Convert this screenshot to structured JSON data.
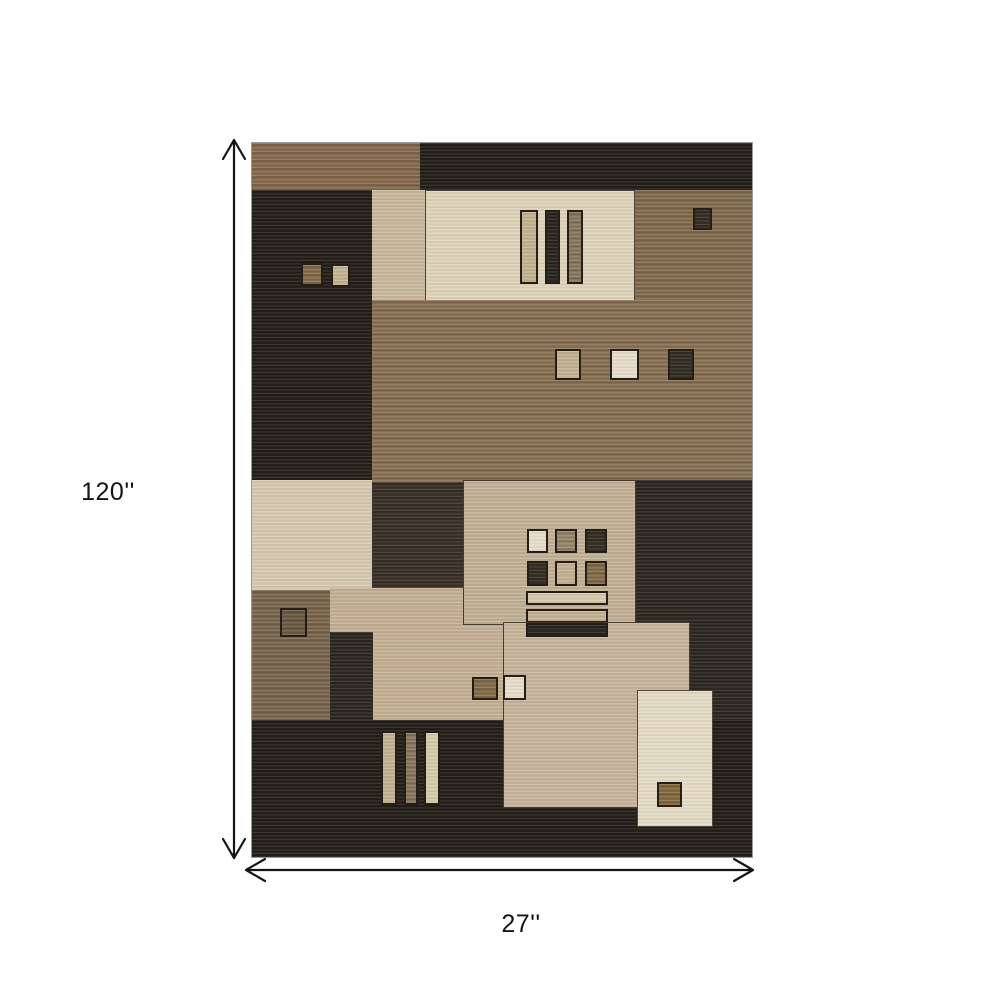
{
  "figure": {
    "description": "Dimension diagram of a brown and beige geometric patchwork area rug",
    "dimensions": {
      "height_label": "120''",
      "width_label": "27''"
    }
  },
  "palette": {
    "page_background": "#ffffff",
    "dimension_text": "#141414",
    "dark0": "#28231e",
    "dark1": "#322c26",
    "dark2": "#3e362e",
    "brown1": "#8a6f51",
    "brown2": "#857051",
    "brown3": "#8d7659",
    "brown4": "#7e6b53",
    "beige1": "#c8b79c",
    "cream1": "#ded3ba",
    "cream2": "#e5dcc6",
    "light1": "#d6c9b0",
    "tan1": "#c0af94",
    "tan2": "#c2af93",
    "tan3": "#c6b39b",
    "sqdark": "#39332b",
    "sqbrown": "#86704e",
    "sqbrown2": "#6f5d45",
    "sqgold": "#8a6f44",
    "sqtan": "#c2b090",
    "sqcream": "#e7deca",
    "sqgraybrown": "#9a8b73",
    "barbrown": "#8d7c63",
    "bardark": "#2e2a24",
    "barcream": "#d6c9ac"
  },
  "rug": {
    "left": 252,
    "top": 143,
    "width": 500,
    "height": 714,
    "blocks": [
      {
        "name": "rug-base",
        "x": 0,
        "y": 0,
        "w": 500,
        "h": 714,
        "fill": "dark0",
        "tex": "dark"
      },
      {
        "name": "band-brown-top-left",
        "x": 0,
        "y": 0,
        "w": 168,
        "h": 47,
        "fill": "brown1",
        "tex": "mid"
      },
      {
        "name": "strip-beige-upper",
        "x": 120,
        "y": 47,
        "w": 53,
        "h": 157,
        "fill": "beige1",
        "tex": "light"
      },
      {
        "name": "panel-cream-top",
        "x": 173,
        "y": 47,
        "w": 210,
        "h": 154,
        "fill": "cream1",
        "tex": "light",
        "line": 1
      },
      {
        "name": "bar-tan-vertical-top",
        "x": 268,
        "y": 67,
        "w": 18,
        "h": 74,
        "fill": "sqtan",
        "tex": "light",
        "line": 2
      },
      {
        "name": "bar-dark-vertical-top",
        "x": 293,
        "y": 67,
        "w": 15,
        "h": 74,
        "fill": "bardark",
        "tex": "dark",
        "line": 2
      },
      {
        "name": "bar-brown-vertical-top",
        "x": 315,
        "y": 67,
        "w": 16,
        "h": 74,
        "fill": "barbrown",
        "tex": "mid",
        "line": 2
      },
      {
        "name": "block-brown-top-right",
        "x": 383,
        "y": 47,
        "w": 117,
        "h": 157,
        "fill": "brown2",
        "tex": "mid"
      },
      {
        "name": "square-dark-top-right",
        "x": 441,
        "y": 65,
        "w": 19,
        "h": 22,
        "fill": "sqdark",
        "tex": "dark",
        "line": 2
      },
      {
        "name": "block-dark-upper-left",
        "x": 0,
        "y": 47,
        "w": 120,
        "h": 337,
        "fill": "dark0",
        "tex": "dark"
      },
      {
        "name": "square-brown-upper-left",
        "x": 49,
        "y": 120,
        "w": 22,
        "h": 23,
        "fill": "sqbrown",
        "tex": "mid",
        "line": 2
      },
      {
        "name": "square-tan-upper-left",
        "x": 79,
        "y": 121,
        "w": 19,
        "h": 23,
        "fill": "sqtan",
        "tex": "light",
        "line": 2
      },
      {
        "name": "block-brown-large",
        "x": 120,
        "y": 157,
        "w": 380,
        "h": 182,
        "fill": "brown3",
        "tex": "mid"
      },
      {
        "name": "square-tan-center",
        "x": 303,
        "y": 206,
        "w": 26,
        "h": 31,
        "fill": "sqtan",
        "tex": "light",
        "line": 2
      },
      {
        "name": "square-cream-center",
        "x": 358,
        "y": 206,
        "w": 29,
        "h": 31,
        "fill": "sqcream",
        "tex": "light",
        "line": 2
      },
      {
        "name": "square-dark-center",
        "x": 416,
        "y": 206,
        "w": 26,
        "h": 31,
        "fill": "sqdark",
        "tex": "dark",
        "line": 2
      },
      {
        "name": "panel-light-left",
        "x": 0,
        "y": 337,
        "w": 120,
        "h": 110,
        "fill": "light1",
        "tex": "light"
      },
      {
        "name": "block-dark-mid",
        "x": 120,
        "y": 339,
        "w": 91,
        "h": 106,
        "fill": "dark2",
        "tex": "dark"
      },
      {
        "name": "region-tan-lower",
        "x": 78,
        "y": 445,
        "w": 310,
        "h": 132,
        "fill": "tan2",
        "tex": "light"
      },
      {
        "name": "panel-tan-mid",
        "x": 211,
        "y": 337,
        "w": 173,
        "h": 145,
        "fill": "tan1",
        "tex": "light",
        "line": 1
      },
      {
        "name": "grid-square-cream",
        "x": 275,
        "y": 386,
        "w": 21,
        "h": 24,
        "fill": "sqcream",
        "tex": "light",
        "line": 2
      },
      {
        "name": "grid-square-graybrown",
        "x": 303,
        "y": 386,
        "w": 22,
        "h": 24,
        "fill": "sqgraybrown",
        "tex": "mid",
        "line": 2
      },
      {
        "name": "grid-square-dark-a",
        "x": 333,
        "y": 386,
        "w": 22,
        "h": 24,
        "fill": "sqdark",
        "tex": "dark",
        "line": 2
      },
      {
        "name": "grid-square-dark-b",
        "x": 275,
        "y": 418,
        "w": 21,
        "h": 25,
        "fill": "sqdark",
        "tex": "dark",
        "line": 2
      },
      {
        "name": "grid-square-tan",
        "x": 303,
        "y": 418,
        "w": 22,
        "h": 25,
        "fill": "sqtan",
        "tex": "light",
        "line": 2
      },
      {
        "name": "grid-square-brown",
        "x": 333,
        "y": 418,
        "w": 22,
        "h": 25,
        "fill": "sqbrown",
        "tex": "mid",
        "line": 2
      },
      {
        "name": "bar-cream-horizontal",
        "x": 274,
        "y": 448,
        "w": 82,
        "h": 14,
        "fill": "barcream",
        "tex": "light",
        "line": 2
      },
      {
        "name": "bar-tan-horizontal",
        "x": 274,
        "y": 466,
        "w": 82,
        "h": 14,
        "fill": "sqtan",
        "tex": "light",
        "line": 2
      },
      {
        "name": "block-dark-right",
        "x": 384,
        "y": 337,
        "w": 116,
        "h": 377,
        "fill": "dark1",
        "tex": "dark"
      },
      {
        "name": "block-brown-lower-left",
        "x": 0,
        "y": 447,
        "w": 78,
        "h": 130,
        "fill": "brown4",
        "tex": "mid"
      },
      {
        "name": "square-outline-brown",
        "x": 28,
        "y": 465,
        "w": 27,
        "h": 29,
        "fill": "sqbrown2",
        "tex": "mid",
        "line": 2
      },
      {
        "name": "strip-dark-lower",
        "x": 78,
        "y": 489,
        "w": 43,
        "h": 88,
        "fill": "dark1",
        "tex": "dark"
      },
      {
        "name": "block-dark-bottom",
        "x": 0,
        "y": 577,
        "w": 500,
        "h": 137,
        "fill": "dark0",
        "tex": "dark"
      },
      {
        "name": "bar-tan-vertical-bottom",
        "x": 129,
        "y": 588,
        "w": 16,
        "h": 74,
        "fill": "sqtan",
        "tex": "light",
        "line": 2
      },
      {
        "name": "bar-brown-vertical-bottom",
        "x": 152,
        "y": 588,
        "w": 14,
        "h": 74,
        "fill": "barbrown",
        "tex": "mid",
        "line": 2
      },
      {
        "name": "bar-cream-vertical-bottom",
        "x": 172,
        "y": 588,
        "w": 16,
        "h": 74,
        "fill": "barcream",
        "tex": "light",
        "line": 2
      },
      {
        "name": "block-tan-large-bottom",
        "x": 251,
        "y": 479,
        "w": 187,
        "h": 186,
        "fill": "tan3",
        "tex": "light",
        "line": 1
      },
      {
        "name": "bar-dark-horizontal",
        "x": 274,
        "y": 480,
        "w": 82,
        "h": 14,
        "fill": "bardark",
        "tex": "dark",
        "line": 2
      },
      {
        "name": "square-brown-small-bottom",
        "x": 220,
        "y": 534,
        "w": 26,
        "h": 23,
        "fill": "sqbrown",
        "tex": "mid",
        "line": 2
      },
      {
        "name": "square-beige-small-bottom",
        "x": 251,
        "y": 532,
        "w": 23,
        "h": 25,
        "fill": "sqcream",
        "tex": "light",
        "line": 2
      },
      {
        "name": "panel-cream-bottom-right",
        "x": 385,
        "y": 547,
        "w": 76,
        "h": 137,
        "fill": "cream2",
        "tex": "light",
        "line": 1
      },
      {
        "name": "square-gold-brown",
        "x": 405,
        "y": 639,
        "w": 25,
        "h": 25,
        "fill": "sqgold",
        "tex": "mid",
        "line": 2
      }
    ]
  }
}
